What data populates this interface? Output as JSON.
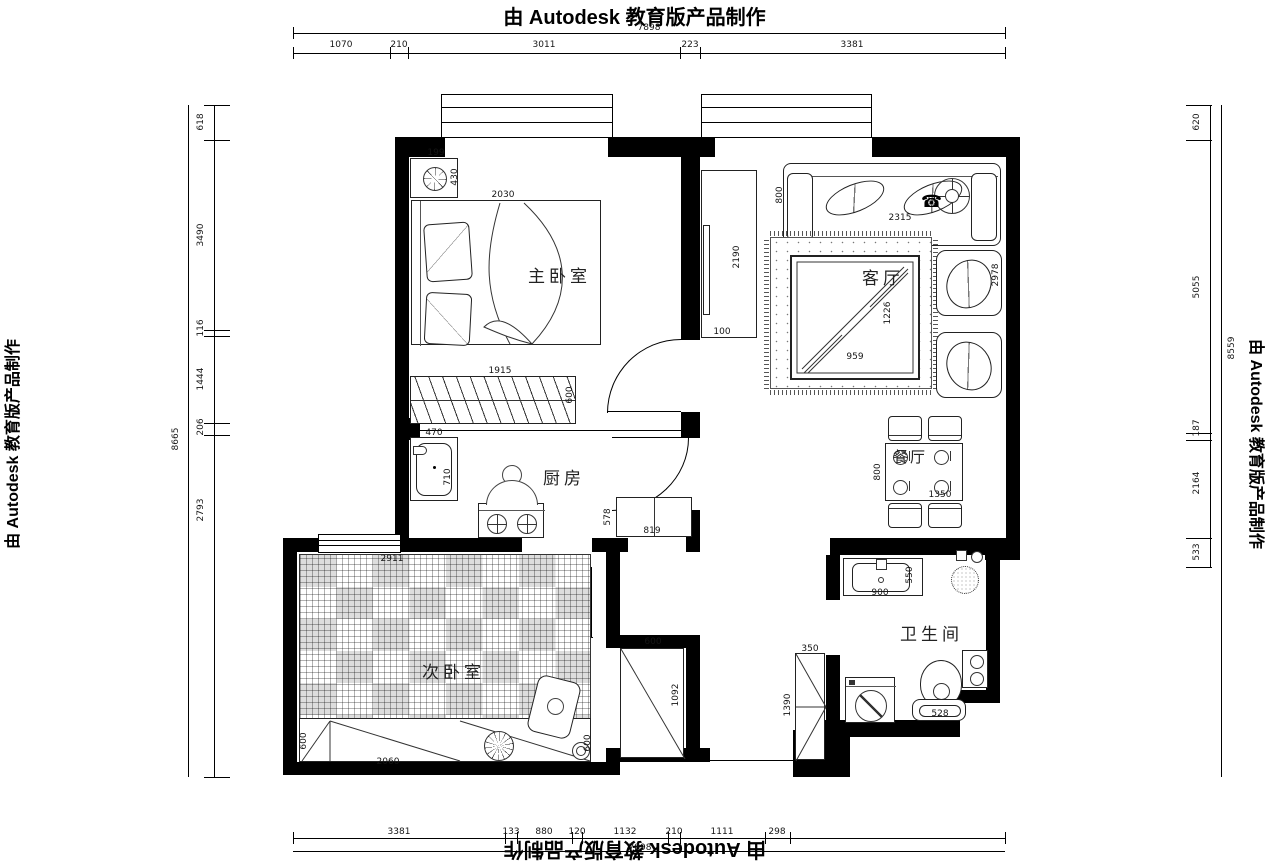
{
  "watermark": {
    "text": "由 Autodesk 教育版产品制作"
  },
  "rooms": {
    "master_bedroom": "主卧室",
    "living_room": "客厅",
    "kitchen": "厨房",
    "second_bedroom": "次卧室",
    "bathroom": "卫生间",
    "dining_room": "餐厅"
  },
  "dims": {
    "top": {
      "total": "7898",
      "segments": [
        "1070",
        "210",
        "3011",
        "223",
        "3381"
      ]
    },
    "left": {
      "total": "8665",
      "segments": [
        "618",
        "3490",
        "116",
        "1444",
        "206",
        "2793"
      ]
    },
    "right": {
      "total": "8559",
      "segments": [
        "620",
        "5055",
        "187",
        "2164",
        "533"
      ]
    },
    "bottom": {
      "total": "7898",
      "segments": [
        "3381",
        "133",
        "880",
        "120",
        "1132",
        "210",
        "1111",
        "298"
      ]
    },
    "interior": {
      "master_cabinet_w": "199",
      "master_cabinet_d": "430",
      "bed_w": "2030",
      "wardrobe_w": "1915",
      "wardrobe_d": "600",
      "tv_wall_h": "2190",
      "tv_wall_w": "100",
      "sofa_d": "800",
      "sofa_w": "2315",
      "chairs_h": "2978",
      "coffee_table_h": "1226",
      "coffee_table_w": "959",
      "dining_d": "800",
      "dining_w": "1350",
      "sink_w": "470",
      "sink_d": "710",
      "counter_d": "578",
      "counter_w": "819",
      "tatami_w": "2911",
      "desk_d_left": "600",
      "desk_w": "2060",
      "desk_d_right": "600",
      "basin_w": "900",
      "basin_d": "550",
      "bath_cabinet_w": "350",
      "bath_cabinet_h": "1390",
      "toilet_w": "528",
      "hall_closet_w": "600",
      "hall_closet_h": "1092"
    }
  }
}
